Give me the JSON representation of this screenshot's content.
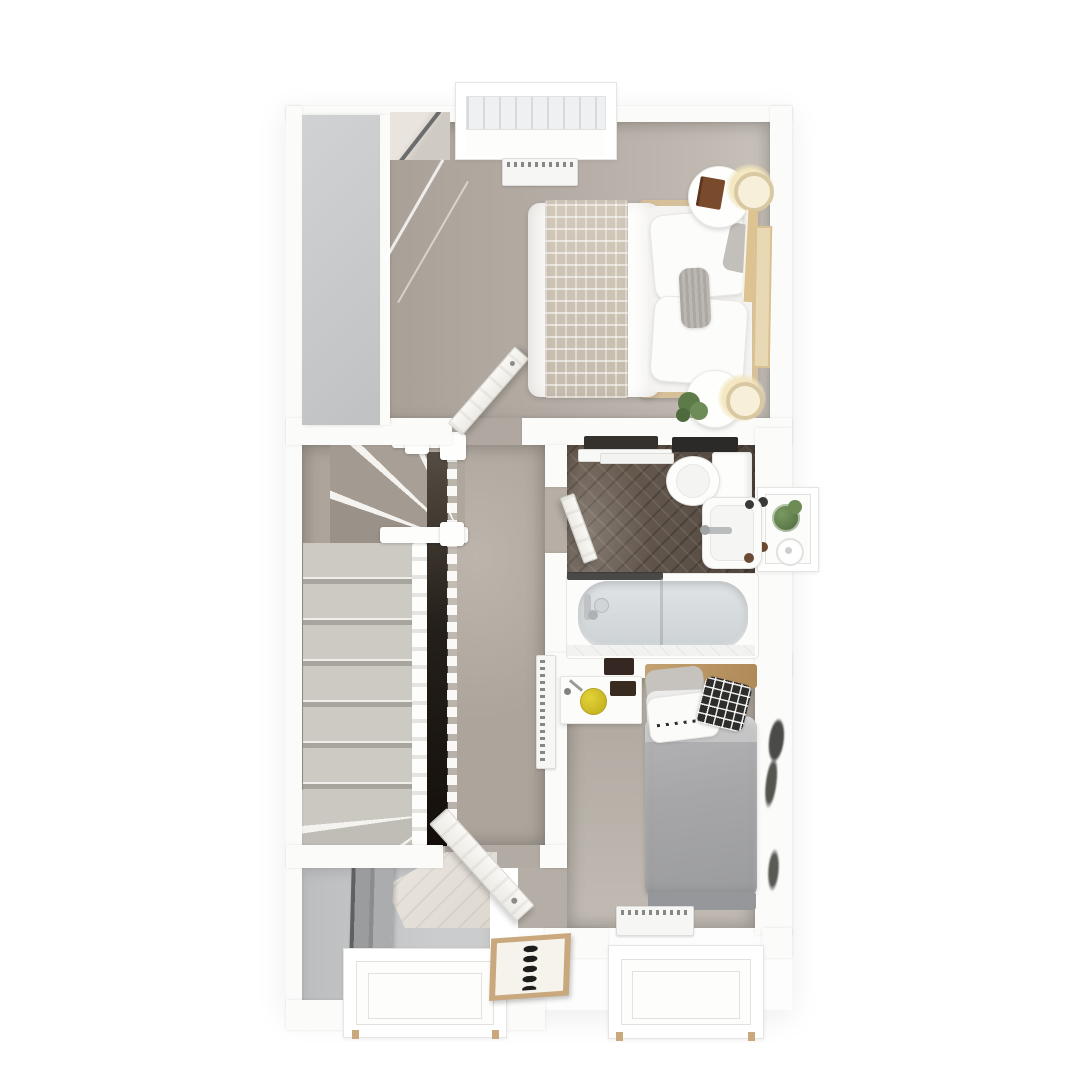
{
  "palette": {
    "page": "#ffffff",
    "wall": "#fbfbfa",
    "wall_edge": "#e8e7e5",
    "carpet1": "#b1a9a1",
    "carpet_landing": "#ada59c",
    "carpet2": "#b7b1a9",
    "wardrobe": "#c6c8c9",
    "gray_floor": "#c8c9ca",
    "mirror_dark": "#77797b",
    "tread": "#cdc9c3",
    "void_dark": "#1b1713",
    "bath_floor": "#5e5349",
    "tile": "#f2f2f0",
    "tub": "#d9dde0",
    "screen": "#3a3a38",
    "wood": "#c9ae84",
    "wood_light": "#d5c09a",
    "throw": "#cec5b7",
    "duvet": "#fbfbf9",
    "gray_pillow": "#b6b2ad",
    "bed2_duvet": "#a8a8aa",
    "checker": "#2d2d2b",
    "rad": "#f6f6f5",
    "rad_dot": "#62625f",
    "glow": "#f7ecc9",
    "glow_ring": "#d9c9a2",
    "plant": "#5f7c4b",
    "book": "#7a4a2d",
    "stool": "#d9c52c",
    "frame_wood": "#c8a87c",
    "ink": "#1d1d1b",
    "door": "#f7f6f4"
  },
  "scene": {
    "type": "3d-floor-plan-top-view",
    "rooms": [
      {
        "name": "bedroom-front",
        "objects": [
          "sliding-wardrobe",
          "double-bed",
          "throw-blanket",
          "pillows",
          "bedside-table",
          "table-lamp",
          "book",
          "plant",
          "leaning-picture-frames",
          "radiator",
          "roman-blind-window",
          "door"
        ]
      },
      {
        "name": "landing",
        "objects": [
          "staircase",
          "winder-steps",
          "banister",
          "handrail",
          "stair-void",
          "radiator",
          "door"
        ]
      },
      {
        "name": "bathroom",
        "objects": [
          "toilet",
          "washbasin",
          "bathtub",
          "shower-screen",
          "towel-rail",
          "window-sill-shelf",
          "plant",
          "toilet-roll",
          "door"
        ]
      },
      {
        "name": "bedroom-rear",
        "objects": [
          "single-bed",
          "headboard",
          "checkered-cushion",
          "dotted-pillow",
          "desk",
          "stool",
          "pinboard",
          "radiator",
          "wall-art",
          "window"
        ]
      },
      {
        "name": "stairwell-below",
        "objects": [
          "mirror-panel",
          "lower-steps",
          "window"
        ]
      }
    ],
    "window_count": 4,
    "framed_art_on_bottom_wall": true
  }
}
